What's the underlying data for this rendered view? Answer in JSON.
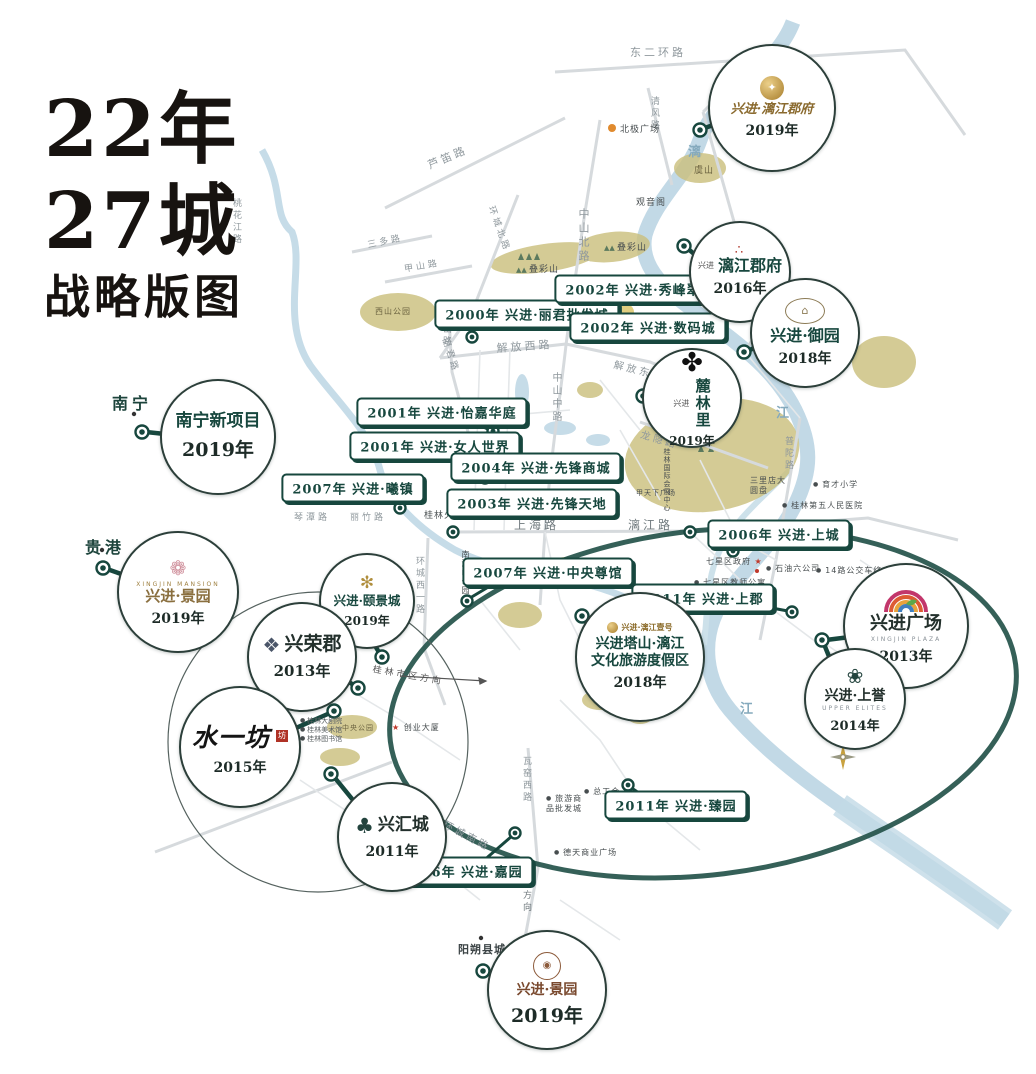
{
  "title": {
    "line1": "22年",
    "line2": "27城",
    "line3": "战略版图"
  },
  "cities": [
    "南宁",
    "贵港",
    "阳朔县城"
  ],
  "projects": [
    {
      "name": "兴进·漓江郡府",
      "year": "2019年",
      "logo": "✦"
    },
    {
      "pre": "兴进",
      "name": "漓江郡府",
      "year": "2016年",
      "logo": "∴"
    },
    {
      "name": "兴进·御园",
      "year": "2018年",
      "logo": "⌂"
    },
    {
      "pre": "兴进",
      "name": "麓林里",
      "year": "2019年",
      "logo": "✤"
    },
    {
      "name": "南宁新项目",
      "year": "2019年"
    },
    {
      "en": "XINGJIN MANSION",
      "name": "兴进·景园",
      "year": "2019年",
      "logo": "❁"
    },
    {
      "name": "兴进·颐景城",
      "year": "2019年",
      "logo": "✻"
    },
    {
      "name": "兴荣郡",
      "year": "2013年",
      "logo": "❖"
    },
    {
      "name": "水一坊",
      "year": "2015年",
      "seal": "坊"
    },
    {
      "name": "兴汇城",
      "year": "2011年",
      "logo": "♣"
    },
    {
      "brand": "兴进·漓江壹号",
      "line1": "兴进塔山·漓江",
      "line2": "文化旅游度假区",
      "year": "2018年",
      "logo": "◉"
    },
    {
      "name": "兴进广场",
      "en": "XINGJIN PLAZA",
      "year": "2013年"
    },
    {
      "name": "兴进·上誉",
      "en": "UPPER ELITES",
      "year": "2014年",
      "logo": "❀"
    },
    {
      "name": "兴进·景园",
      "year": "2019年",
      "logo": "◉"
    }
  ],
  "tags": [
    "2000年 兴进·丽君批发城",
    "2002年 兴进·秀峰翠苑",
    "2002年 兴进·数码城",
    "2001年 兴进·怡嘉华庭",
    "2001年 兴进·女人世界",
    "2004年 兴进·先锋商城",
    "2003年 兴进·先锋天地",
    "2007年 兴进·曦镇",
    "2006年 兴进·上城",
    "2007年 兴进·中央尊馆",
    "2011年 兴进·上郡",
    "2011年 兴进·臻园",
    "2006年 兴进·嘉园"
  ],
  "roads": [
    "东二环路",
    "清风路",
    "芦笛路",
    "环城北路",
    "三多路",
    "甲山路",
    "桃花江路",
    "中山北路",
    "西山路",
    "丽君路",
    "解放西路",
    "解放东路",
    "中山中路",
    "建干路",
    "琴潭路",
    "丽竹路",
    "上海路",
    "漓江路",
    "龙隐路",
    "普陀路",
    "环城西一路",
    "瓦窑西路",
    "环城南路",
    "阳朔方向",
    "桂林市区方向"
  ],
  "pois": [
    "北极广场",
    "虞山",
    "观音阁",
    "叠彩山",
    "叠彩山",
    "西山公园",
    "桂林火车站",
    "南溪山公园",
    "七星区政府",
    "七星区教师公寓",
    "石油六公司",
    "14路公交车终点站",
    "三里店大圆盘",
    "育才小学",
    "桂林第五人民医院",
    "总工会",
    "旅游商品批发城",
    "德天商业广场",
    "创业大厦",
    "中央公园",
    "桂林大剧院",
    "桂林美术馆",
    "桂林图书馆",
    "桂林国际会展中心",
    "甲天下广场"
  ],
  "river_labels": [
    "漓",
    "江",
    "江"
  ],
  "compass": "N",
  "colors": {
    "accent": "#17473e",
    "river": "#c2d9e6",
    "hill": "#cbc07e",
    "gold": "#a07c2e",
    "seal_red": "#b03226"
  }
}
